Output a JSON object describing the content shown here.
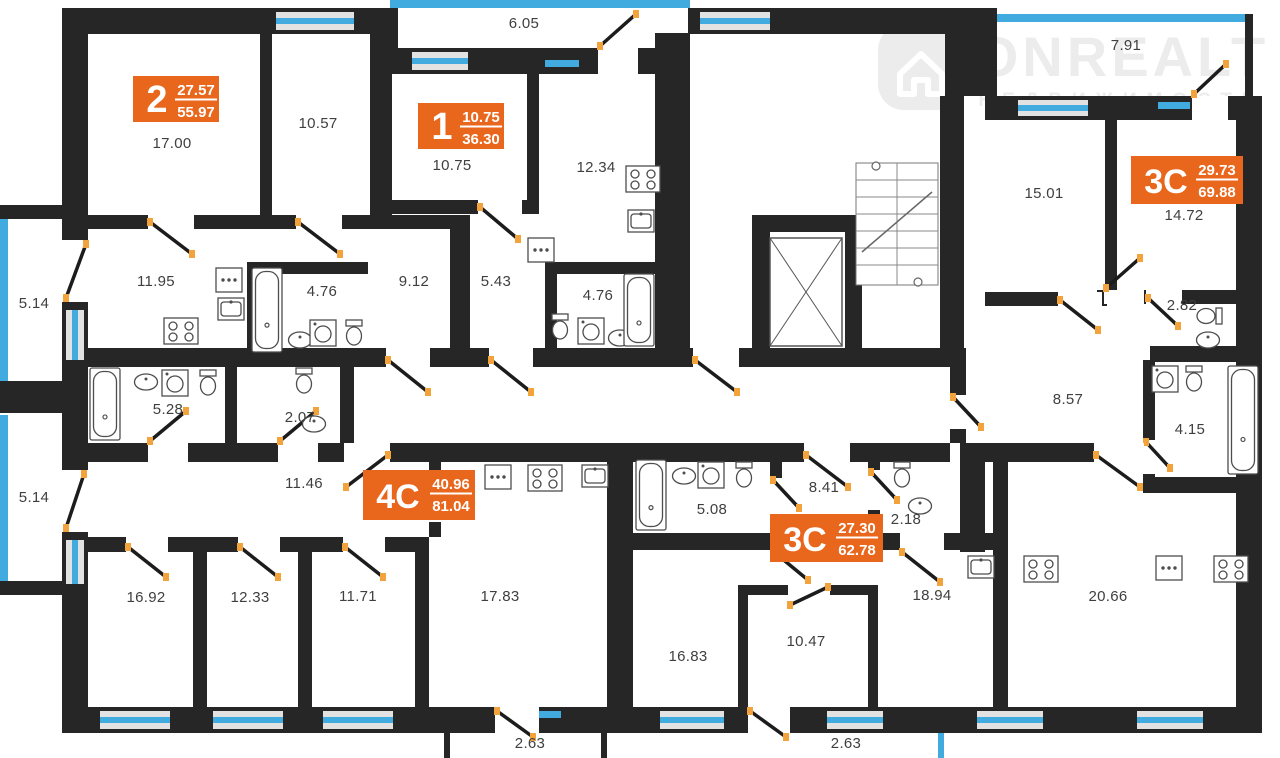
{
  "logo": {
    "name": "ONREALT",
    "subtitle": "НЕДВИЖИМОСТЬ"
  },
  "apartments": [
    {
      "type": "2",
      "living": "27.57",
      "total": "55.97"
    },
    {
      "type": "1",
      "living": "10.75",
      "total": "36.30"
    },
    {
      "type": "3C",
      "living": "29.73",
      "total": "69.88"
    },
    {
      "type": "4C",
      "living": "40.96",
      "total": "81.04"
    },
    {
      "type": "3C",
      "living": "27.30",
      "total": "62.78"
    }
  ],
  "rooms": [
    "17.00",
    "10.57",
    "6.05",
    "10.75",
    "12.34",
    "7.91",
    "15.01",
    "14.72",
    "2.82",
    "11.95",
    "4.76",
    "9.12",
    "5.43",
    "4.76",
    "5.14",
    "5.14",
    "5.28",
    "2.07",
    "11.46",
    "8.57",
    "4.15",
    "8.41",
    "5.08",
    "2.18",
    "16.92",
    "12.33",
    "11.71",
    "17.83",
    "2.63",
    "16.83",
    "10.47",
    "18.94",
    "20.66",
    "2.63"
  ],
  "colors": {
    "wall": "#262626",
    "accent_orange": "#E8671C",
    "window_blue": "#41AADF",
    "window_frame": "#E2E2E2",
    "door_hinge": "#F2A33C",
    "label": "#3F3F3F",
    "fixture": "#4D4D4D",
    "watermark": "#ECECEC"
  }
}
